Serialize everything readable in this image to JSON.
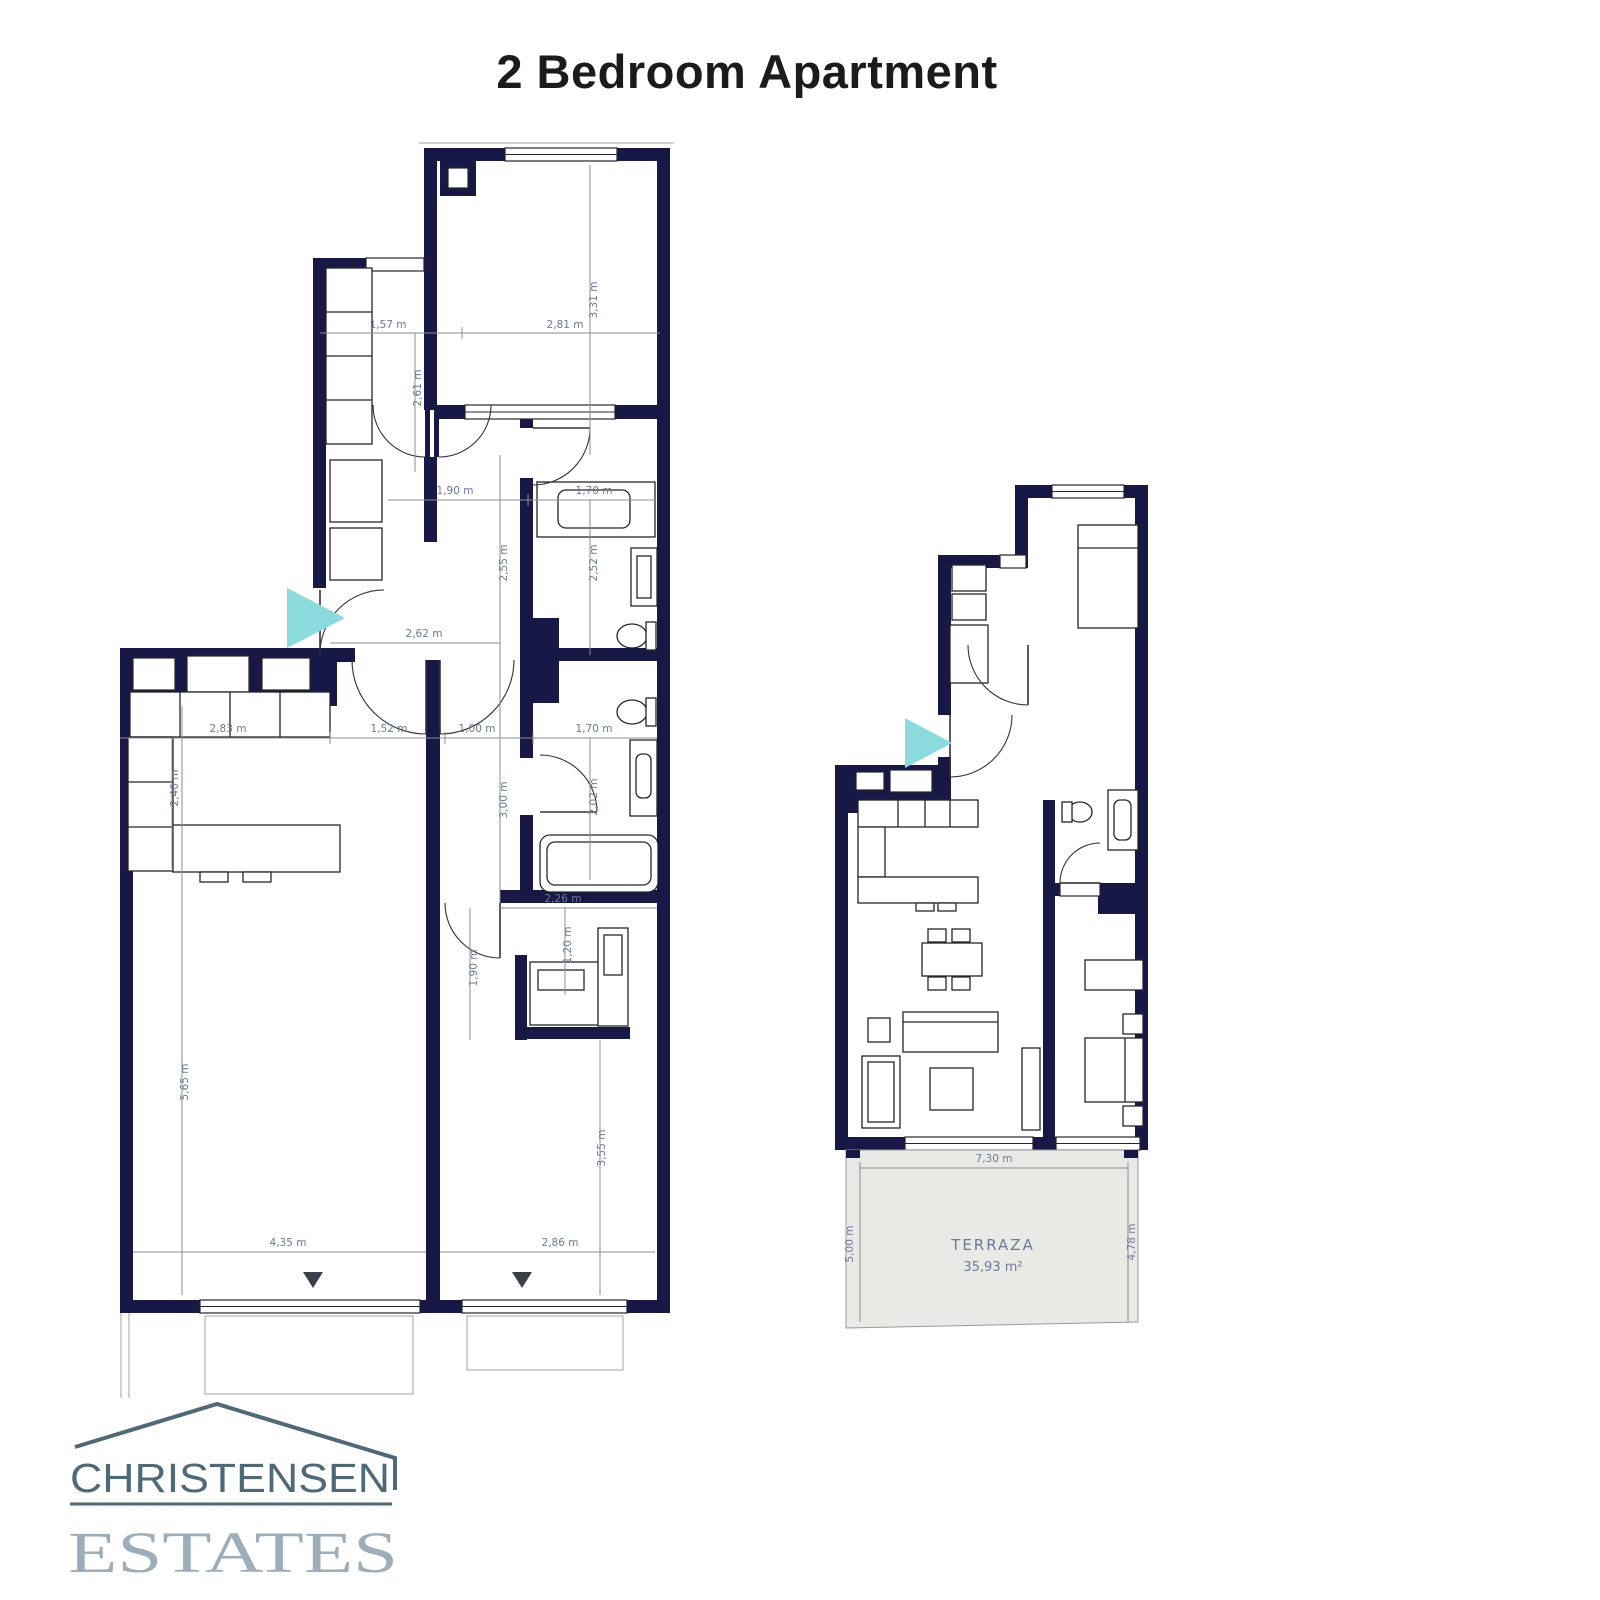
{
  "title": "2 Bedroom Apartment",
  "logo": {
    "line1": "CHRISTENSEN",
    "line2": "ESTATES"
  },
  "plans": {
    "left": {
      "name": "dimensioned-plan",
      "dims": {
        "w157": "1,57 m",
        "w281": "2,81 m",
        "h331": "3,31 m",
        "h261": "2,61 m",
        "w190": "1,90 m",
        "w170a": "1,70 m",
        "h255": "2,55 m",
        "h252": "2,52 m",
        "w262": "2,62 m",
        "w283": "2,83 m",
        "w152": "1,52 m",
        "w100": "1,00 m",
        "w170b": "1,70 m",
        "h240": "2,40 m",
        "h300": "3,00 m",
        "h202": "2,02 m",
        "w226": "2,26 m",
        "h190": "1,90 m",
        "h120": "1,20 m",
        "h565": "5,65 m",
        "h355": "3,55 m",
        "w435": "4,35 m",
        "w286": "2,86 m"
      }
    },
    "right": {
      "name": "furnished-plan",
      "terrace": {
        "label": "TERRAZA",
        "area": "35,93 m²",
        "w730": "7,30 m",
        "h500": "5,00 m",
        "h478": "4,78 m"
      }
    }
  },
  "colors": {
    "wall": "#171845",
    "dimension_text": "#6b7a99",
    "entrance_arrow": "#8adade",
    "terrace_fill": "#e9e9e6",
    "logo_dark": "#4e6a79",
    "logo_light": "#9daebb",
    "title_text": "#1b1b1d"
  }
}
